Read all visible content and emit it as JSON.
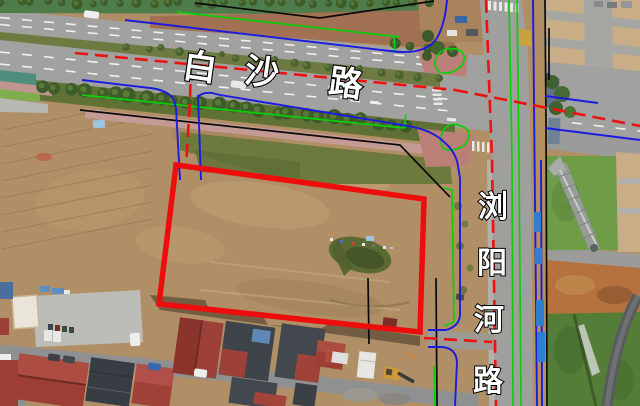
{
  "figure": {
    "type": "annotated-satellite-planning-map"
  },
  "labels": {
    "baisha": {
      "text": "白沙路",
      "chars": [
        "白",
        "沙",
        "路"
      ]
    },
    "liuyanghe": {
      "text": "浏阳河路",
      "chars": [
        "浏",
        "阳",
        "河",
        "路"
      ]
    }
  },
  "overlay_colors": {
    "parcel": "#ed0d0d",
    "centerline": "#ee1111",
    "curb": "#1a1ae0",
    "green_line": "#0ad00a",
    "boundary": "#0a0a0a"
  },
  "parcel": {
    "points": "176,165 424,199 420,332 159,304"
  }
}
